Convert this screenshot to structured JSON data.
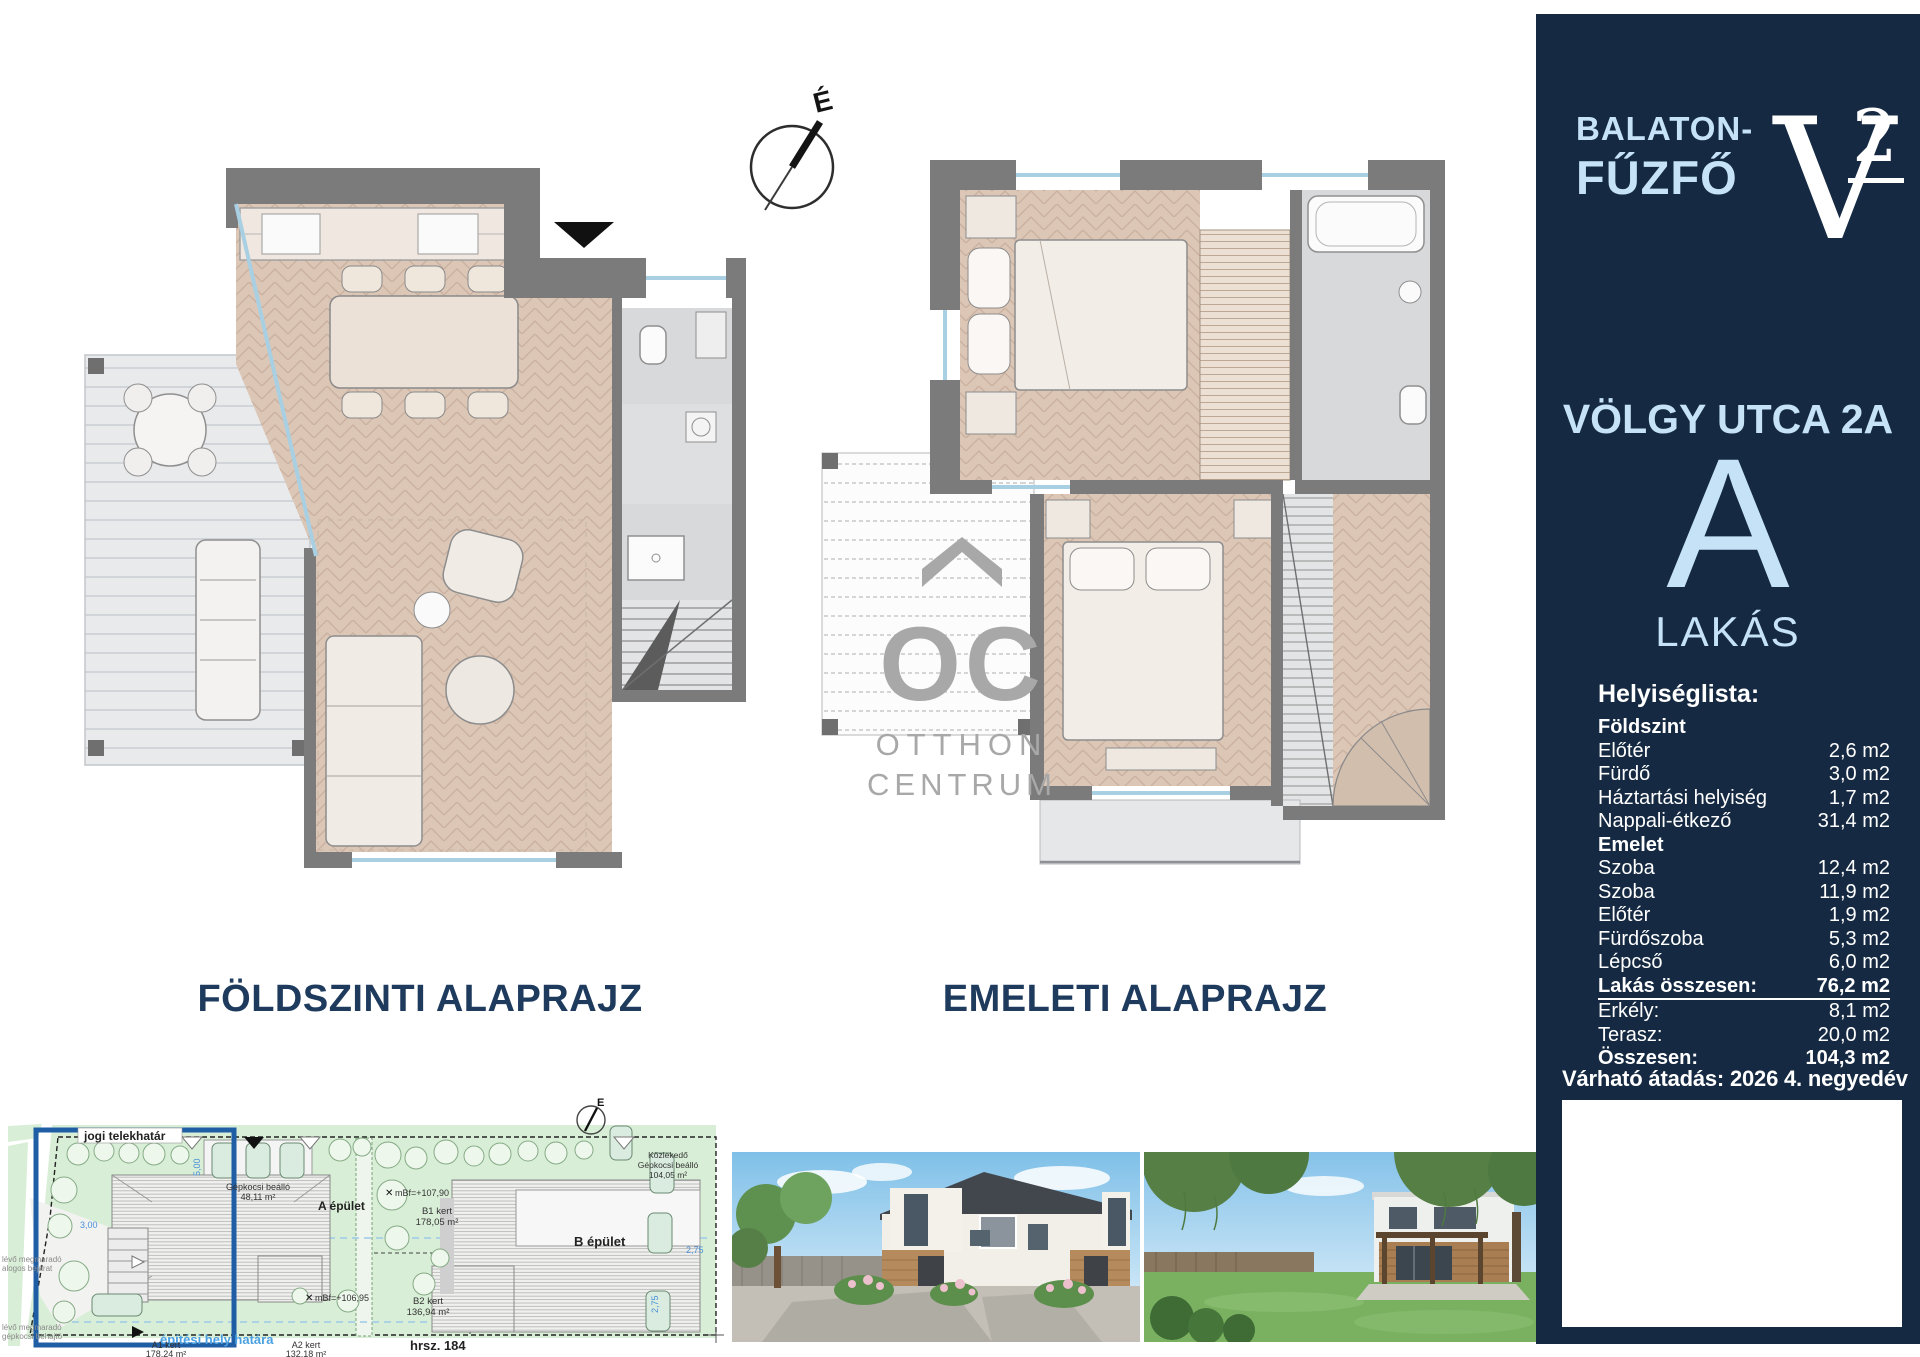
{
  "plans": {
    "ground_label": "FÖLDSZINTI ALAPRAJZ",
    "upper_label": "EMELETI ALAPRAJZ",
    "compass_letter": "É"
  },
  "watermark": {
    "letters": "OC",
    "line1": "OTTHON",
    "line2": "CENTRUM"
  },
  "sidebar": {
    "location_line1": "BALATON-",
    "location_line2": "FŰZFŐ",
    "logo_letter": "V",
    "logo_sup": "2",
    "address": "VÖLGY UTCA 2A",
    "unit_letter": "A",
    "unit_type": "LAKÁS",
    "list_title": "Helyiséglista:",
    "rows": [
      {
        "label": "Földszint",
        "value": ""
      },
      {
        "label": "Előtér",
        "value": "2,6 m2"
      },
      {
        "label": "Fürdő",
        "value": "3,0 m2"
      },
      {
        "label": "Háztartási helyiség",
        "value": "1,7 m2"
      },
      {
        "label": "Nappali-étkező",
        "value": "31,4 m2"
      },
      {
        "label": "Emelet",
        "value": ""
      },
      {
        "label": "Szoba",
        "value": "12,4 m2"
      },
      {
        "label": "Szoba",
        "value": "11,9 m2"
      },
      {
        "label": "Előtér",
        "value": "1,9 m2"
      },
      {
        "label": "Fürdőszoba",
        "value": "5,3 m2"
      },
      {
        "label": "Lépcső",
        "value": "6,0 m2"
      },
      {
        "label": "Lakás összesen:",
        "value": "76,2 m2"
      },
      {
        "label": "Erkély:",
        "value": "8,1 m2"
      },
      {
        "label": "Terasz:",
        "value": "20,0 m2"
      },
      {
        "label": "Összesen:",
        "value": "104,3 m2"
      }
    ],
    "delivery": "Várható átadás: 2026 4. negyedév",
    "colors": {
      "bg": "#152a42",
      "accent": "#c5e2f6",
      "text": "#ffffff"
    }
  },
  "site_plan": {
    "boundary_label": "jogi telekhatár",
    "carport_label": "Gépkocsi beálló",
    "carport_area": "48,11 m²",
    "building_a": "A épület",
    "building_b": "B épület",
    "b1_label": "B1 kert",
    "b1_area": "178,05 m²",
    "b2_label": "B2 kert",
    "b2_area": "136,94 m²",
    "a1_label": "A1 kert",
    "a1_area": "178,24 m²",
    "a2_label": "A2 kert",
    "a2_area": "132,18 m²",
    "parcel": "hrsz. 184",
    "building_line_label": "építési hely határa",
    "level_a": "mBf=+107,90",
    "level_b": "mBf=+106,95",
    "access_label1": "Közlekedő",
    "access_label2": "Gépkocsi beálló",
    "access_area": "104,05 m²",
    "note_left_1a": "lévő megmaradó",
    "note_left_1b": "alogos bejárat",
    "note_left_2a": "lévő megmaradó",
    "note_left_2b": "gépkocsi behajtó",
    "dim_1": "2,75",
    "dim_2": "2,75",
    "dim_3": "5,00",
    "dim_4": "3,00",
    "compass_letter": "É"
  }
}
